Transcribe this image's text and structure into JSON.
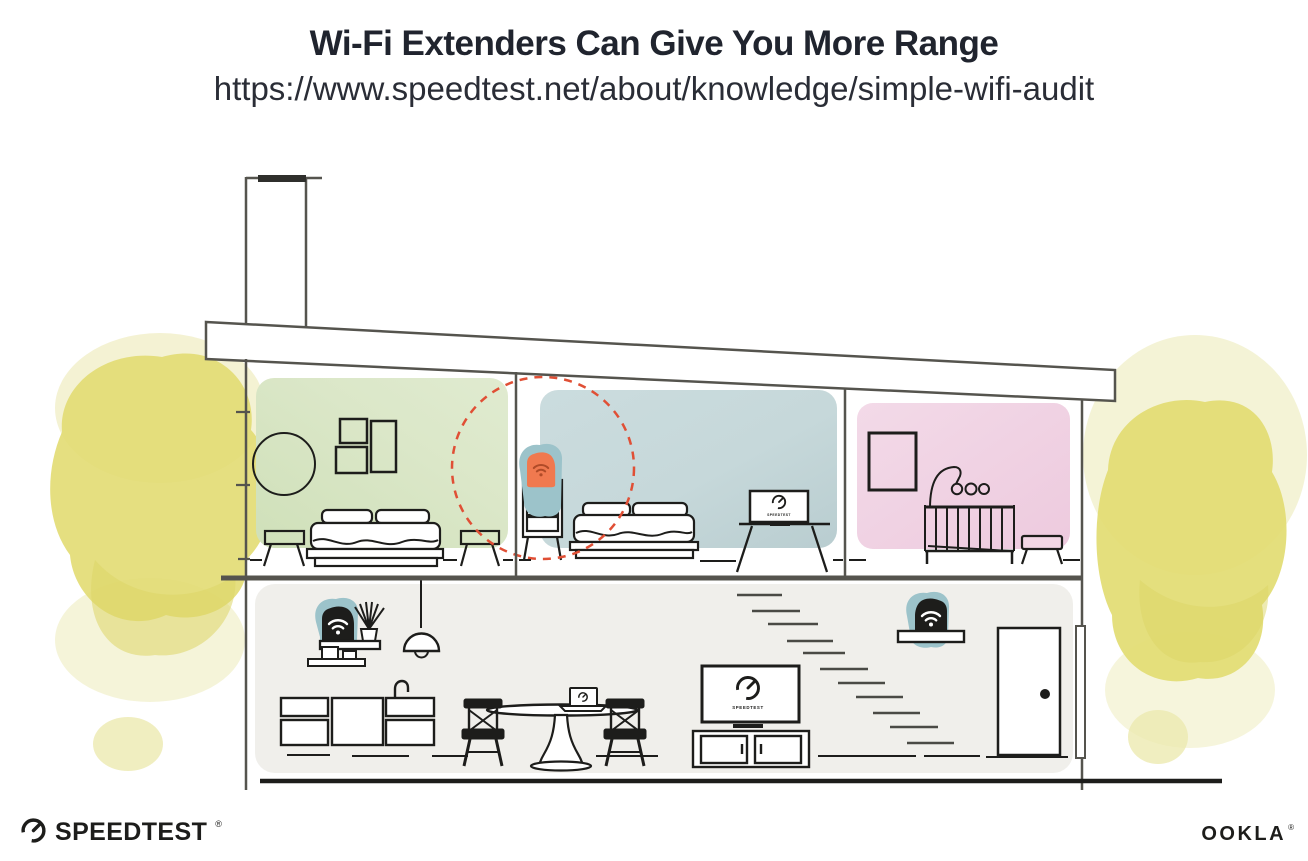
{
  "header": {
    "title": "Wi-Fi Extenders Can Give You More Range",
    "url": "https://www.speedtest.net/about/knowledge/simple-wifi-audit"
  },
  "screens": {
    "bedroom_tv_label": "SPEEDTEST",
    "living_room_tv_label": "SPEEDTEST"
  },
  "footer": {
    "speedtest_wordmark": "SPEEDTEST",
    "speedtest_reg": "®",
    "ookla_wordmark": "OOKLA",
    "ookla_reg": "®"
  },
  "icons": {
    "wifi_icon": "wifi-arcs-with-dot",
    "speedtest_gauge_icon": "open-dial-with-needle",
    "door_knob_icon": "black-dot"
  },
  "colors": {
    "title_text": "#20242e",
    "wall_line": "#55544e",
    "furniture_line": "#1d1d1b",
    "bedroom_green": "#d9e6c6",
    "bedroom_blue": "#c6d8da",
    "nursery_pink": "#f2d6e5",
    "ground_floor_gray": "#f0efeb",
    "device_teal": "#9cc3ca",
    "extender_orange": "#f0794f",
    "extender_wifi": "#b04b28",
    "signal_red": "#e04f35",
    "bush_yellow": "#e2dc72",
    "bush_yellow_light": "#f0eec4"
  }
}
